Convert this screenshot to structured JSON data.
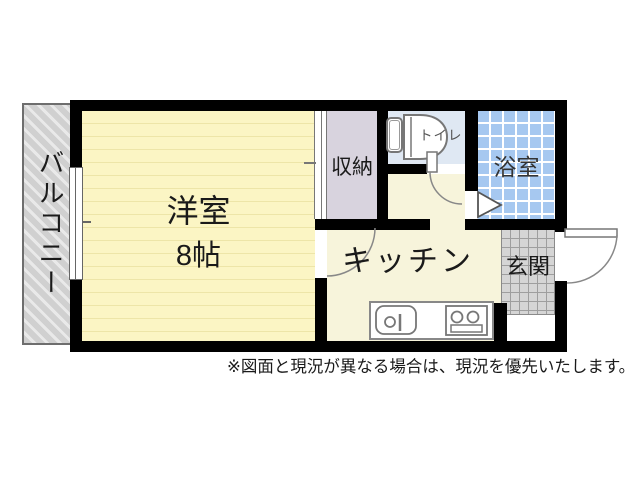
{
  "rooms": {
    "western_room": {
      "label": "洋室",
      "size": "8帖"
    },
    "balcony": {
      "label": "バルコニー"
    },
    "closet": {
      "label": "収納"
    },
    "toilet": {
      "label": "トイレ"
    },
    "bathroom": {
      "label": "浴室"
    },
    "kitchen": {
      "label": "キッチン"
    },
    "entrance": {
      "label": "玄関"
    }
  },
  "note": {
    "text": "※図面と現況が異なる場合は、現況を優先いたします。"
  },
  "icons": {
    "toilet-icon": "svg-shape (tank + bowl)",
    "sink-icon": "svg-shape (basin + drain + faucet)",
    "stove-icon": "svg-shape (two burners + grill)",
    "window-icon": "css-shape (double glazing lines)",
    "sliding-door-icon": "css-shape (double track band)",
    "folding-door-icon": "svg-triangle",
    "door-swing-arc": "svg-quarter-arc"
  },
  "colors": {
    "wall": "#000000",
    "room_yellow": "#FBF5C4",
    "room_stripe": "#EDE5A8",
    "kitchen_cream": "#F7F4DB",
    "closet_gray": "#D8D3DE",
    "toilet_blue": "#DFE8F3",
    "bath_blue": "#A6C8F0",
    "genkan_gray": "#D5D5D5",
    "genkan_grid": "#9E9E9E",
    "balcony_gray": "#D0D0D0",
    "balcony_stripe": "#E9E9E9",
    "line_gray": "#777777",
    "text_dark": "#1A1A1A"
  }
}
